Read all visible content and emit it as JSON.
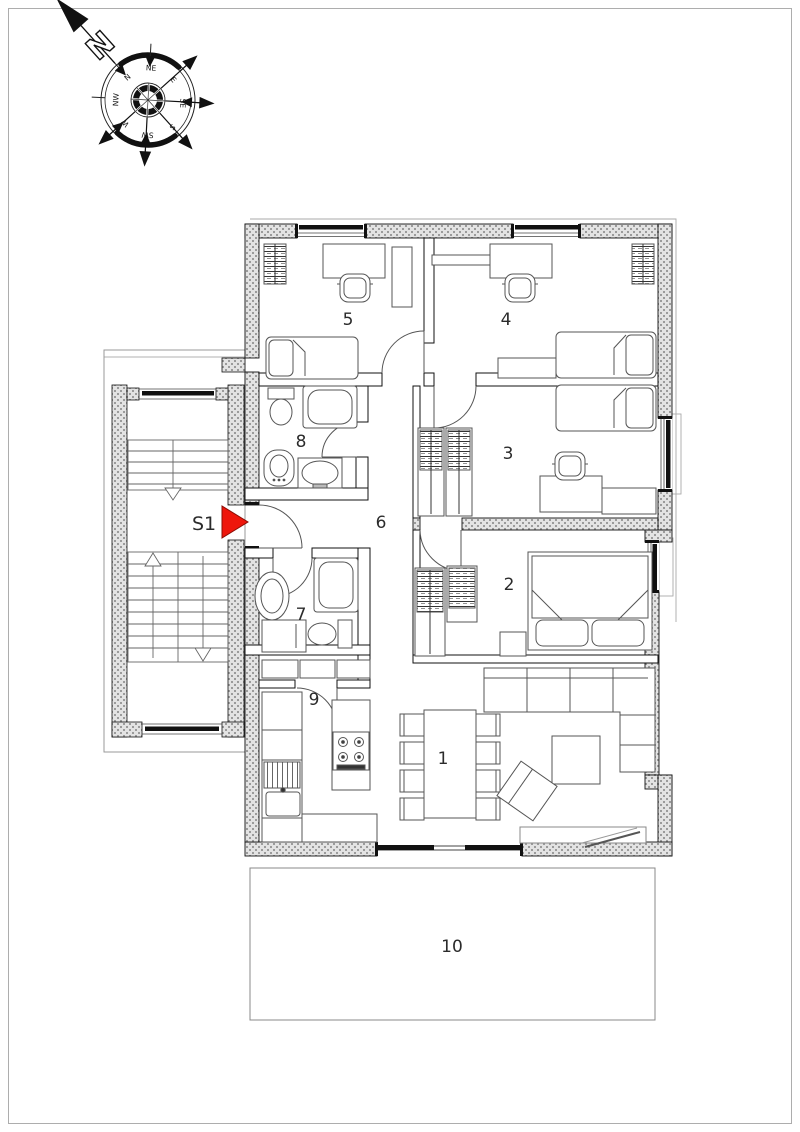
{
  "compass": {
    "north_letter": "N",
    "direction_labels": [
      "N",
      "NE",
      "E",
      "SE",
      "S",
      "SW",
      "W",
      "NW"
    ]
  },
  "entrance": {
    "label": "S1",
    "arrow_color": "#ee160c"
  },
  "rooms": [
    {
      "label": "1"
    },
    {
      "label": "2"
    },
    {
      "label": "3"
    },
    {
      "label": "4"
    },
    {
      "label": "5"
    },
    {
      "label": "6"
    },
    {
      "label": "7"
    },
    {
      "label": "8"
    },
    {
      "label": "9"
    },
    {
      "label": "10"
    }
  ],
  "colors": {
    "wall_fill": "#e3e3e3",
    "wall_dot": "#9b9b9b",
    "line": "#333333"
  }
}
